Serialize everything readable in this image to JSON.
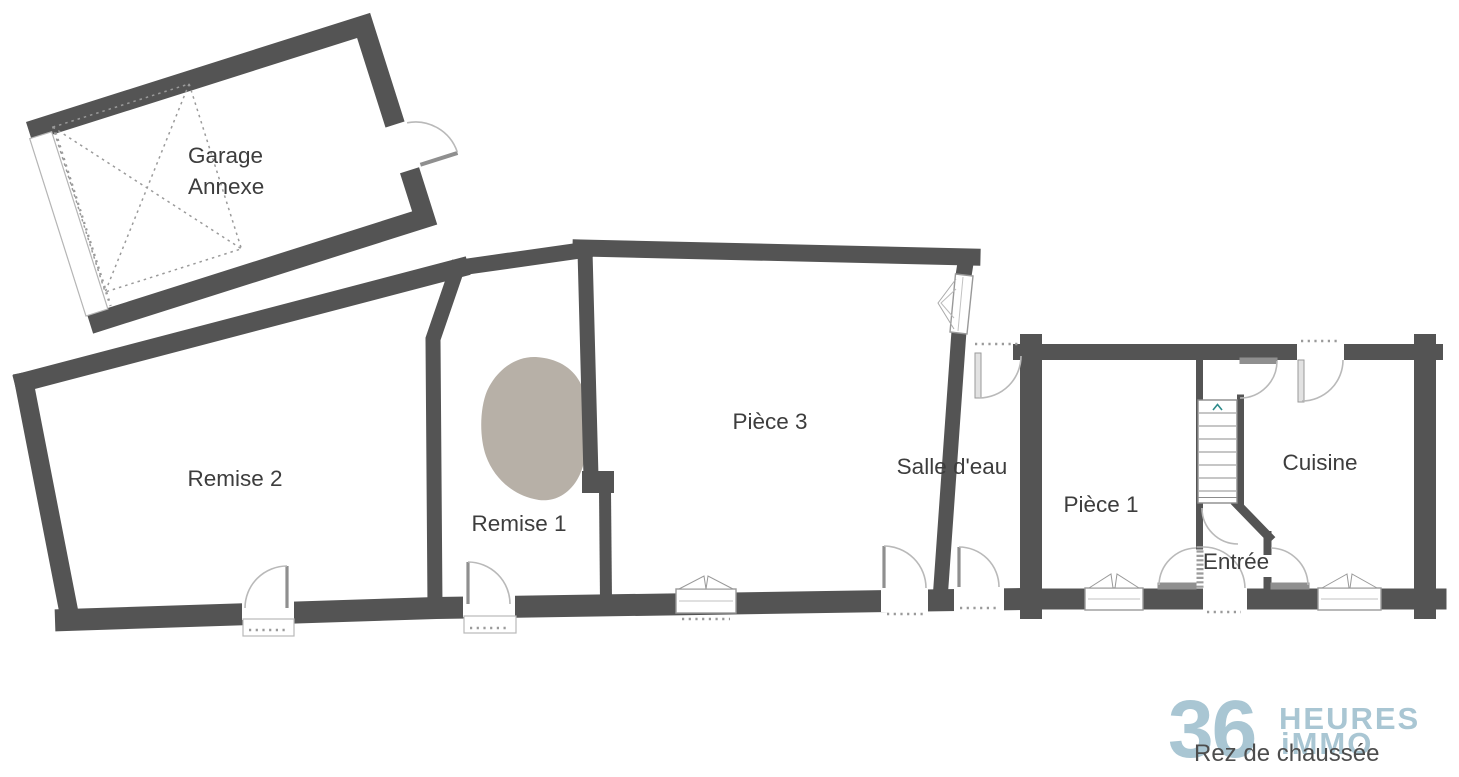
{
  "floor": {
    "label": "Rez de chaussée"
  },
  "rooms": {
    "garage": {
      "label_line1": "Garage",
      "label_line2": "Annexe"
    },
    "remise2": {
      "label": "Remise 2"
    },
    "remise1": {
      "label": "Remise 1"
    },
    "piece3": {
      "label": "Pièce 3"
    },
    "salle_deau": {
      "label": "Salle d'eau"
    },
    "piece1": {
      "label": "Pièce 1"
    },
    "cuisine": {
      "label": "Cuisine"
    },
    "entree": {
      "label": "Entrée"
    }
  },
  "logo": {
    "number": "36",
    "word1": "HEURES",
    "word2": "iMMO"
  },
  "colors": {
    "wall": "#545454",
    "door": "#b9b9b9",
    "leaf": "#8f8f8f",
    "window_border": "#999999",
    "dots": "#9a9a9a",
    "blob": "#b7b0a7",
    "logo_blue": "#a9c6d3",
    "label_text": "#3d3d3d",
    "footer_text": "#4d4d4d",
    "stair_arrow": "#2e8b8b"
  }
}
